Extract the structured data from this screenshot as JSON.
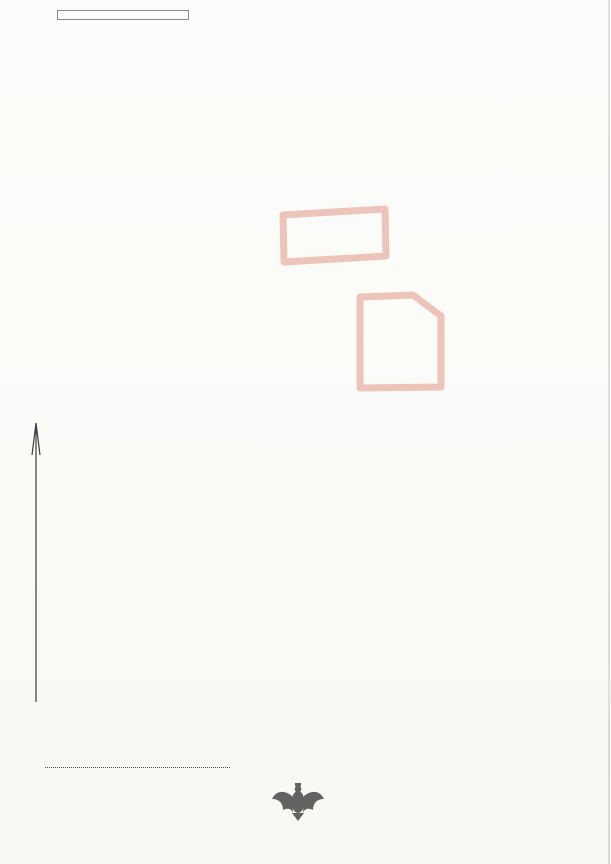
{
  "colors": {
    "red": "#c23a28",
    "line": "#57575d",
    "bld": "#313137",
    "stamp": "#83789f",
    "ink": "#3f3a58"
  },
  "header": {
    "office": {
      "line1": "STAROSTA POLICKI",
      "line2": "ul. Tanowska 8",
      "line3": "72-010 Police"
    },
    "title": "Wyrys z mapy ewidencyjnej",
    "subtitle": "skala 1:1000",
    "region": {
      "line1": "Województwo zachodniopomorskie",
      "line2": "Powiat policki",
      "line3": "Jedn. ewidencyjna: Police - miasto",
      "line4": "Obręb: Police 8, Police 10"
    }
  },
  "map": {
    "labels": [
      {
        "t": "3270/11",
        "x": 52,
        "y": 28
      },
      {
        "t": "3270/6",
        "x": 125,
        "y": 20,
        "s": 7
      },
      {
        "t": "dr",
        "x": 123,
        "y": 29,
        "s": 7
      },
      {
        "t": "3270/3",
        "x": 149,
        "y": 39
      },
      {
        "t": "m2",
        "x": 224,
        "y": 49
      },
      {
        "t": "396",
        "x": 241,
        "y": 40,
        "s": 4.5
      },
      {
        "t": "Bp",
        "x": 279,
        "y": 72
      },
      {
        "t": "3270/4",
        "x": 279,
        "y": 81
      },
      {
        "t": "3270/12",
        "x": 68,
        "y": 86
      },
      {
        "t": "Bp",
        "x": 68,
        "y": 97
      },
      {
        "t": "6",
        "x": 168,
        "y": 93
      },
      {
        "t": "k2",
        "x": 175,
        "y": 117
      },
      {
        "t": "52",
        "x": 184,
        "y": 111,
        "s": 4.5
      },
      {
        "t": "7",
        "x": 219,
        "y": 90,
        "r": 90
      },
      {
        "t": "m2",
        "x": 219,
        "y": 119
      },
      {
        "t": "53",
        "x": 228,
        "y": 107,
        "s": 4.5
      },
      {
        "t": "2047",
        "x": 221,
        "y": 143
      },
      {
        "t": "B",
        "x": 219,
        "y": 152
      },
      {
        "t": "2046",
        "x": 165,
        "y": 154
      },
      {
        "t": "Bi",
        "x": 164,
        "y": 164
      },
      {
        "t": "3270/13",
        "x": 68,
        "y": 179
      },
      {
        "t": "Bp",
        "x": 70,
        "y": 189
      },
      {
        "t": "RIVb",
        "x": 227,
        "y": 180
      },
      {
        "t": "59",
        "x": 236,
        "y": 188,
        "s": 4.5
      },
      {
        "t": "264",
        "x": 374,
        "y": 29
      },
      {
        "t": "g",
        "x": 370,
        "y": 67
      },
      {
        "t": "B",
        "x": 369,
        "y": 80
      },
      {
        "t": "172",
        "x": 389,
        "y": 63,
        "s": 4.5
      },
      {
        "t": "2381/1",
        "x": 297,
        "y": 166
      },
      {
        "t": "Bp",
        "x": 295,
        "y": 178
      },
      {
        "t": "3275",
        "x": 465,
        "y": 73
      },
      {
        "t": "B",
        "x": 463,
        "y": 83
      },
      {
        "t": "m3",
        "x": 511,
        "y": 98
      },
      {
        "t": "490",
        "x": 511,
        "y": 107,
        "s": 5
      },
      {
        "t": "3a",
        "x": 497,
        "y": 28,
        "s": 5,
        "r": 90
      },
      {
        "t": "3b",
        "x": 498,
        "y": 71,
        "s": 5,
        "r": 90
      },
      {
        "t": "3c",
        "x": 500,
        "y": 121,
        "s": 5,
        "r": 90
      },
      {
        "t": "3d",
        "x": 502,
        "y": 173,
        "s": 5,
        "r": 90
      },
      {
        "t": "2733/1",
        "x": 553,
        "y": 17,
        "s": 6
      },
      {
        "t": "496",
        "x": 558,
        "y": 25,
        "s": 4.5
      },
      {
        "t": "2",
        "x": 556,
        "y": 33,
        "s": 6
      },
      {
        "t": "Bi",
        "x": 556,
        "y": 42,
        "s": 6
      },
      {
        "t": "306",
        "x": 457,
        "y": 170,
        "u": 1
      },
      {
        "t": "dr",
        "x": 442,
        "y": 188
      },
      {
        "t": "3270/7",
        "x": 81,
        "y": 239
      },
      {
        "t": "3270/16",
        "x": 66,
        "y": 300
      },
      {
        "t": "2381/2",
        "x": 293,
        "y": 218
      },
      {
        "t": "dr",
        "x": 293,
        "y": 227
      },
      {
        "t": "2381/3",
        "x": 199,
        "y": 283
      },
      {
        "t": "Bp",
        "x": 199,
        "y": 294
      },
      {
        "t": "2381/4",
        "x": 295,
        "y": 274
      },
      {
        "t": "Bp",
        "x": 294,
        "y": 285
      },
      {
        "t": "2381/5",
        "x": 375,
        "y": 281
      },
      {
        "t": "Bp",
        "x": 373,
        "y": 293
      },
      {
        "t": "2633/4",
        "x": 480,
        "y": 251
      },
      {
        "t": "Bi",
        "x": 478,
        "y": 261
      },
      {
        "t": "h2",
        "x": 530,
        "y": 258
      },
      {
        "t": "489",
        "x": 503,
        "y": 239,
        "s": 4.5
      },
      {
        "t": "3062",
        "x": 495,
        "y": 339
      },
      {
        "t": "Bi",
        "x": 493,
        "y": 349
      },
      {
        "t": "3063/1",
        "x": 553,
        "y": 339,
        "s": 7
      },
      {
        "t": "Bp",
        "x": 548,
        "y": 349
      },
      {
        "t": "g",
        "x": 529,
        "y": 322,
        "s": 6
      },
      {
        "t": "377",
        "x": 528,
        "y": 300,
        "s": 4.5
      },
      {
        "t": "370",
        "x": 524,
        "y": 365,
        "s": 4.5
      },
      {
        "t": "b3",
        "x": 512,
        "y": 381
      },
      {
        "t": "16",
        "x": 512,
        "y": 400
      },
      {
        "t": "Bp",
        "x": 40,
        "y": 382
      },
      {
        "t": "280/63",
        "x": 56,
        "y": 408
      },
      {
        "t": "280/64",
        "x": 126,
        "y": 401
      },
      {
        "t": "Bp",
        "x": 125,
        "y": 411
      },
      {
        "t": "280/30",
        "x": 190,
        "y": 373
      },
      {
        "t": "B",
        "x": 190,
        "y": 384
      },
      {
        "t": "305",
        "x": 178,
        "y": 385,
        "s": 4.5
      },
      {
        "t": "i2",
        "x": 178,
        "y": 402
      },
      {
        "t": "280/31",
        "x": 244,
        "y": 367
      },
      {
        "t": "B",
        "x": 245,
        "y": 379
      },
      {
        "t": "308",
        "x": 224,
        "y": 369,
        "s": 4.5
      },
      {
        "t": "i",
        "x": 224,
        "y": 392
      },
      {
        "t": "306",
        "x": 255,
        "y": 378,
        "s": 4.5
      },
      {
        "t": "t",
        "x": 255,
        "y": 390,
        "s": 6.5
      },
      {
        "t": "2381/8",
        "x": 284,
        "y": 375
      },
      {
        "t": "Bi",
        "x": 282,
        "y": 386
      },
      {
        "t": "z2",
        "x": 319,
        "y": 384
      },
      {
        "t": "320",
        "x": 320,
        "y": 353,
        "s": 4.5
      },
      {
        "t": "20",
        "x": 311,
        "y": 411
      },
      {
        "t": "2381/7",
        "x": 380,
        "y": 366
      },
      {
        "t": "Bi",
        "x": 378,
        "y": 378
      },
      {
        "t": "i2",
        "x": 378,
        "y": 408
      },
      {
        "t": "147",
        "x": 391,
        "y": 394,
        "s": 4.5
      },
      {
        "t": "18",
        "x": 384,
        "y": 432
      },
      {
        "t": "m3",
        "x": 189,
        "y": 443
      },
      {
        "t": "24",
        "x": 191,
        "y": 462
      },
      {
        "t": "m2",
        "x": 237,
        "y": 437
      },
      {
        "t": "304",
        "x": 250,
        "y": 427,
        "s": 4.5
      },
      {
        "t": "22",
        "x": 238,
        "y": 459
      },
      {
        "t": "26",
        "x": 137,
        "y": 465
      },
      {
        "t": "2676/1",
        "x": 364,
        "y": 457
      },
      {
        "t": "dr",
        "x": 398,
        "y": 446
      },
      {
        "t": "Grunwaldzka",
        "x": 89,
        "y": 519,
        "s": 9,
        "r": -8
      },
      {
        "t": "154,15e",
        "x": 392,
        "y": 487,
        "s": 6,
        "r": 184
      },
      {
        "t": "2677",
        "x": 35,
        "y": 628
      },
      {
        "t": "b3",
        "x": 109,
        "y": 628
      },
      {
        "t": "244",
        "x": 118,
        "y": 608,
        "s": 4.5
      },
      {
        "t": "Bi",
        "x": 191,
        "y": 579
      },
      {
        "t": "2037/95",
        "x": 207,
        "y": 581
      },
      {
        "t": "2037/96",
        "x": 236,
        "y": 546,
        "u": 1
      },
      {
        "t": "m3",
        "x": 294,
        "y": 550
      },
      {
        "t": "247",
        "x": 297,
        "y": 533,
        "s": 4.5
      },
      {
        "t": "B",
        "x": 276,
        "y": 552,
        "s": 6.5
      },
      {
        "t": "k2",
        "x": 310,
        "y": 609
      },
      {
        "t": "242",
        "x": 316,
        "y": 572,
        "s": 4.5
      },
      {
        "t": "dr",
        "x": 344,
        "y": 568
      },
      {
        "t": "Traugutta",
        "x": 374,
        "y": 600,
        "s": 8,
        "r": 74
      },
      {
        "t": "2678",
        "x": 409,
        "y": 640
      },
      {
        "t": "2037/84",
        "x": 461,
        "y": 509,
        "s": 7
      },
      {
        "t": "2037/85",
        "x": 498,
        "y": 513,
        "s": 7
      },
      {
        "t": "B",
        "x": 500,
        "y": 523
      },
      {
        "t": "Bi",
        "x": 542,
        "y": 526
      },
      {
        "t": "2037/111",
        "x": 548,
        "y": 535,
        "s": 7
      },
      {
        "t": "2037/148",
        "x": 499,
        "y": 606,
        "s": 7
      },
      {
        "t": "B",
        "x": 501,
        "y": 616
      },
      {
        "t": "s",
        "x": 525,
        "y": 567,
        "s": 6
      },
      {
        "t": "s",
        "x": 548,
        "y": 556,
        "s": 6
      },
      {
        "t": "350",
        "x": 429,
        "y": 546,
        "s": 4.5
      },
      {
        "t": "59",
        "x": 452,
        "y": 596,
        "s": 4.5
      },
      {
        "t": "17",
        "x": 474,
        "y": 471,
        "s": 6,
        "r": 180
      },
      {
        "t": "m3",
        "x": 488,
        "y": 482,
        "s": 7
      },
      {
        "t": "2",
        "x": 543,
        "y": 462,
        "s": 7
      },
      {
        "t": "15",
        "x": 556,
        "y": 453,
        "s": 7
      },
      {
        "t": "i3",
        "x": 539,
        "y": 481,
        "s": 6
      },
      {
        "t": "154",
        "x": 540,
        "y": 470,
        "s": 4
      },
      {
        "t": "2037/107",
        "x": 548,
        "y": 492,
        "s": 6
      },
      {
        "t": "15a,15c",
        "x": 549,
        "y": 504,
        "s": 5.5,
        "r": 182
      },
      {
        "t": "N",
        "x": 8,
        "y": 618,
        "s": 24
      }
    ]
  },
  "footer": {
    "issued": [
      "Wydano z systemu GEO-INFO",
      "zarejestrowanego w ewidencji",
      "ZWINGiK pod Nr 7611-11/2009"
    ],
    "prepared": [
      "Sporządzono w Ośrodku Dokumentacji",
      "Geodezyjnej i Kartograficznej",
      "Wydziału Geodezji, Kartografii i Katastru",
      "Starostwa Powiatowego w Policach"
    ],
    "order_label": "Nr ks. zam.",
    "order_value": "3318/13",
    "purpose": [
      "Dokument niniejszy jest przeznaczony",
      "do dokonania wpisu w księdze wieczystej"
    ],
    "prepared_by_label": "Sporządził(a):",
    "clerk_stamp": [
      "z up. STAROSTY",
      "Anna",
      "Geodeta",
      "w Wydziale Geodezji,",
      "Kartografii i Katastru"
    ],
    "round_stamp": {
      "ring_text": "STAROSTA POLICKI",
      "bottom_text": "* 4 *"
    },
    "date": "Police, dnia: 30-04-2013 r."
  }
}
